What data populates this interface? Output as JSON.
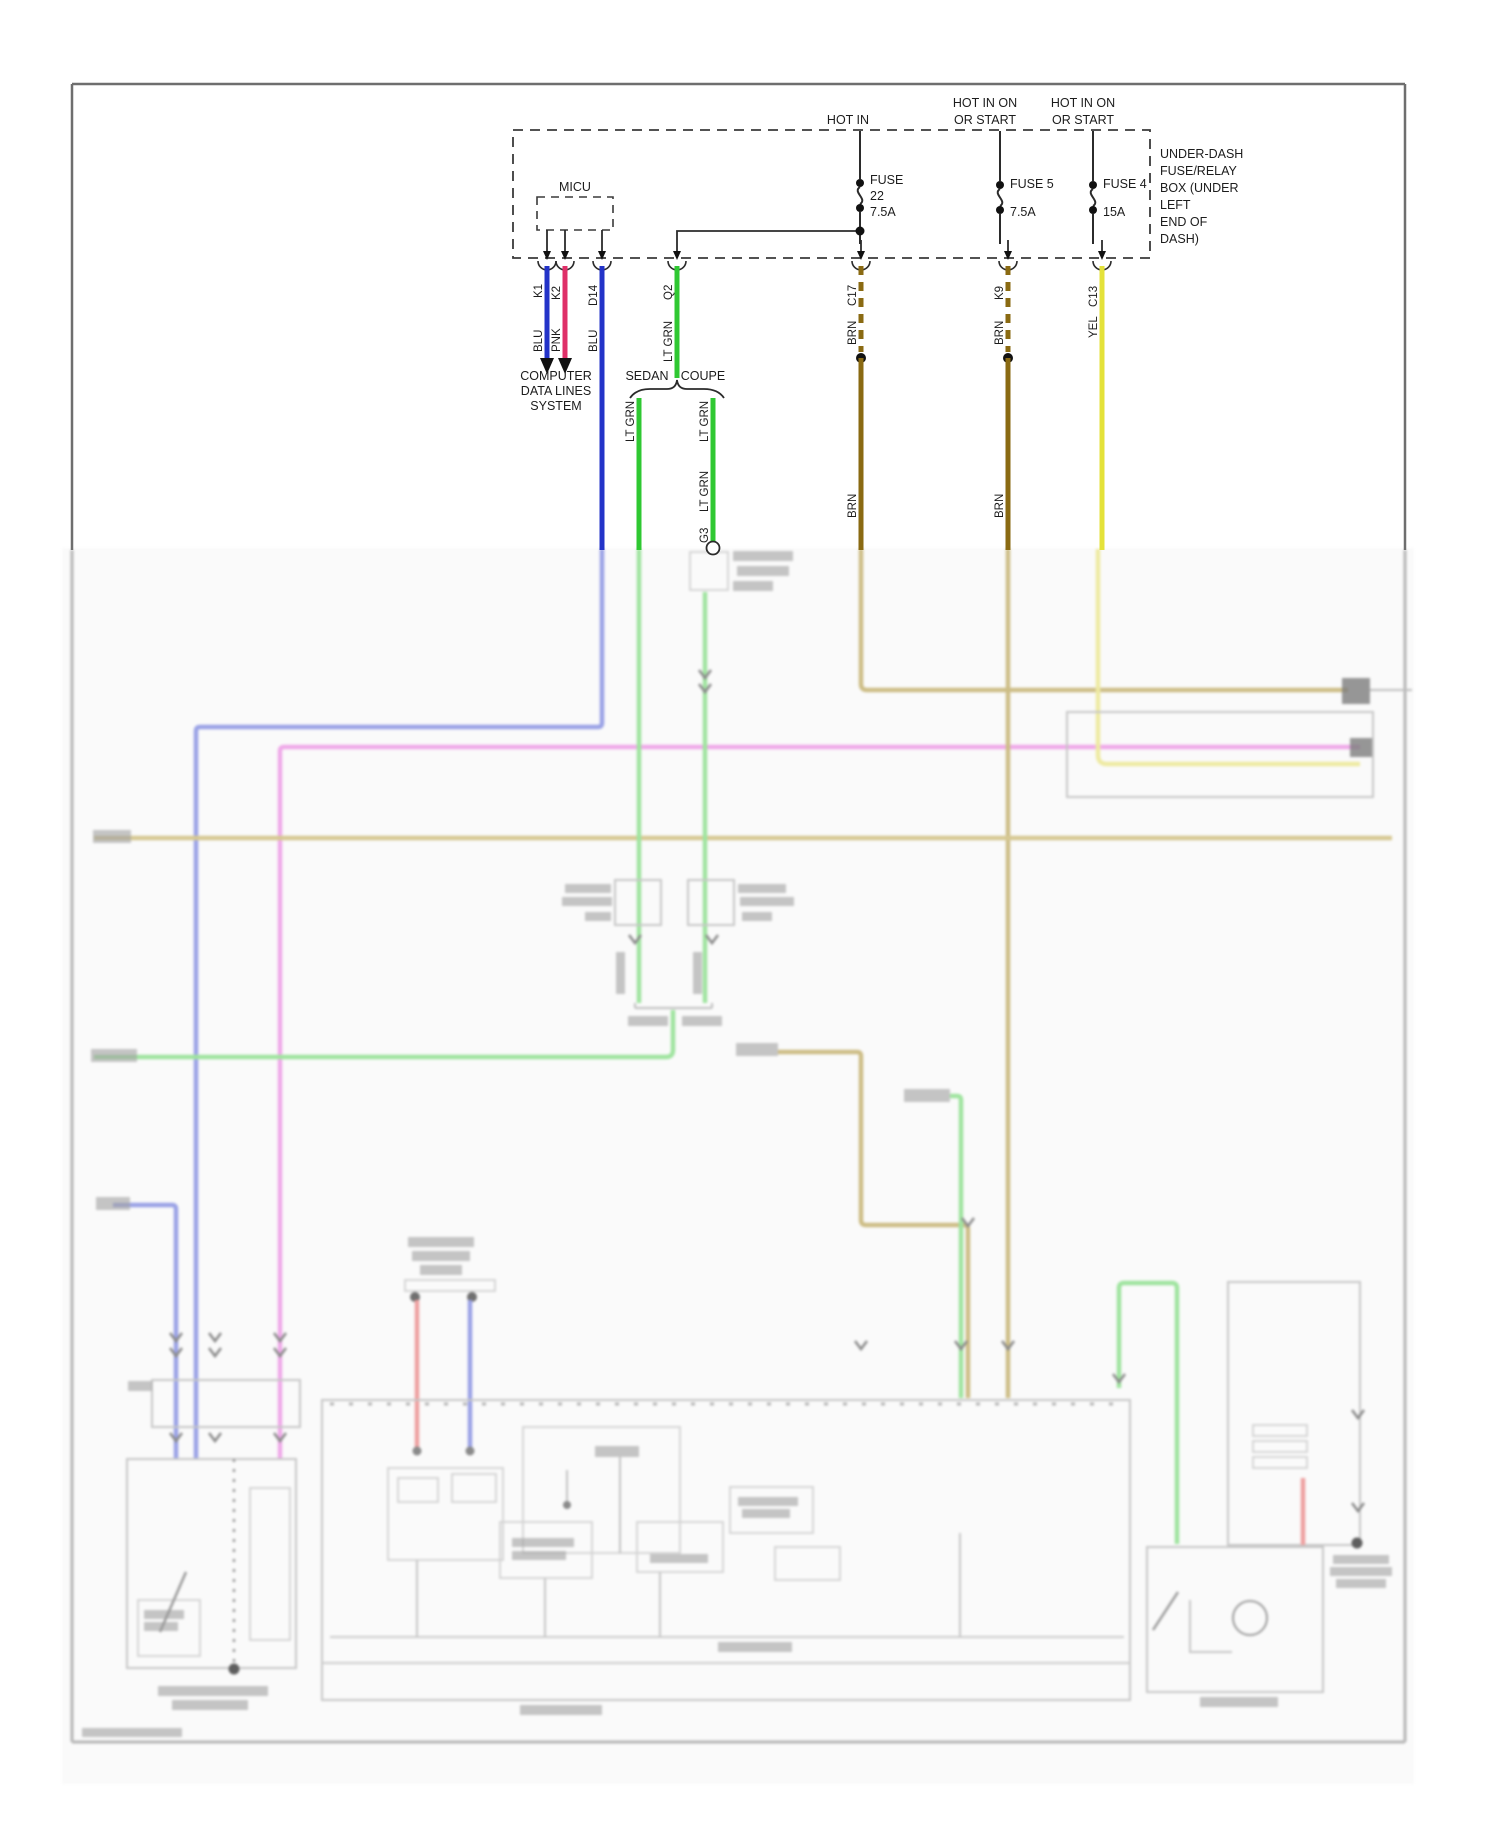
{
  "diagram": {
    "fuse_box": {
      "note_lines": [
        "UNDER-DASH",
        "FUSE/RELAY",
        "BOX (UNDER",
        "LEFT",
        "END OF",
        "DASH)"
      ],
      "micu_label": "MICU",
      "feeds": [
        {
          "hot_lines": [
            "HOT IN"
          ],
          "fuse_lines": [
            "FUSE",
            "22",
            "7.5A"
          ]
        },
        {
          "hot_lines": [
            "HOT IN ON",
            "OR START"
          ],
          "fuse_lines": [
            "FUSE 5",
            "7.5A"
          ]
        },
        {
          "hot_lines": [
            "HOT IN ON",
            "OR START"
          ],
          "fuse_lines": [
            "FUSE 4",
            "15A"
          ]
        }
      ]
    },
    "connectors": [
      {
        "pin": "K1",
        "wire": "BLU"
      },
      {
        "pin": "K2",
        "wire": "PNK"
      },
      {
        "pin": "D14",
        "wire": "BLU"
      },
      {
        "pin": "Q2",
        "wire": "LT GRN"
      },
      {
        "pin": "C17",
        "wire": "BRN",
        "wire_below_splice": "BRN"
      },
      {
        "pin": "K9",
        "wire": "BRN",
        "wire_below_splice": "BRN"
      },
      {
        "pin": "C13",
        "wire": "YEL"
      }
    ],
    "computer_data_lines": [
      "COMPUTER",
      "DATA LINES",
      "SYSTEM"
    ],
    "body_variants": {
      "sedan": "SEDAN",
      "coupe": "COUPE"
    },
    "branch_wires": {
      "sedan_wire": "LT GRN",
      "coupe_wire": "LT GRN",
      "coupe_wire_lower": "LT GRN",
      "coupe_pin": "G3"
    },
    "colors": {
      "blu": "#2333c8",
      "pnk": "#df2f68",
      "lt_grn": "#2fc832",
      "brn": "#8a6a12",
      "yel": "#e4e23a",
      "line": "#2b2b2b"
    }
  }
}
